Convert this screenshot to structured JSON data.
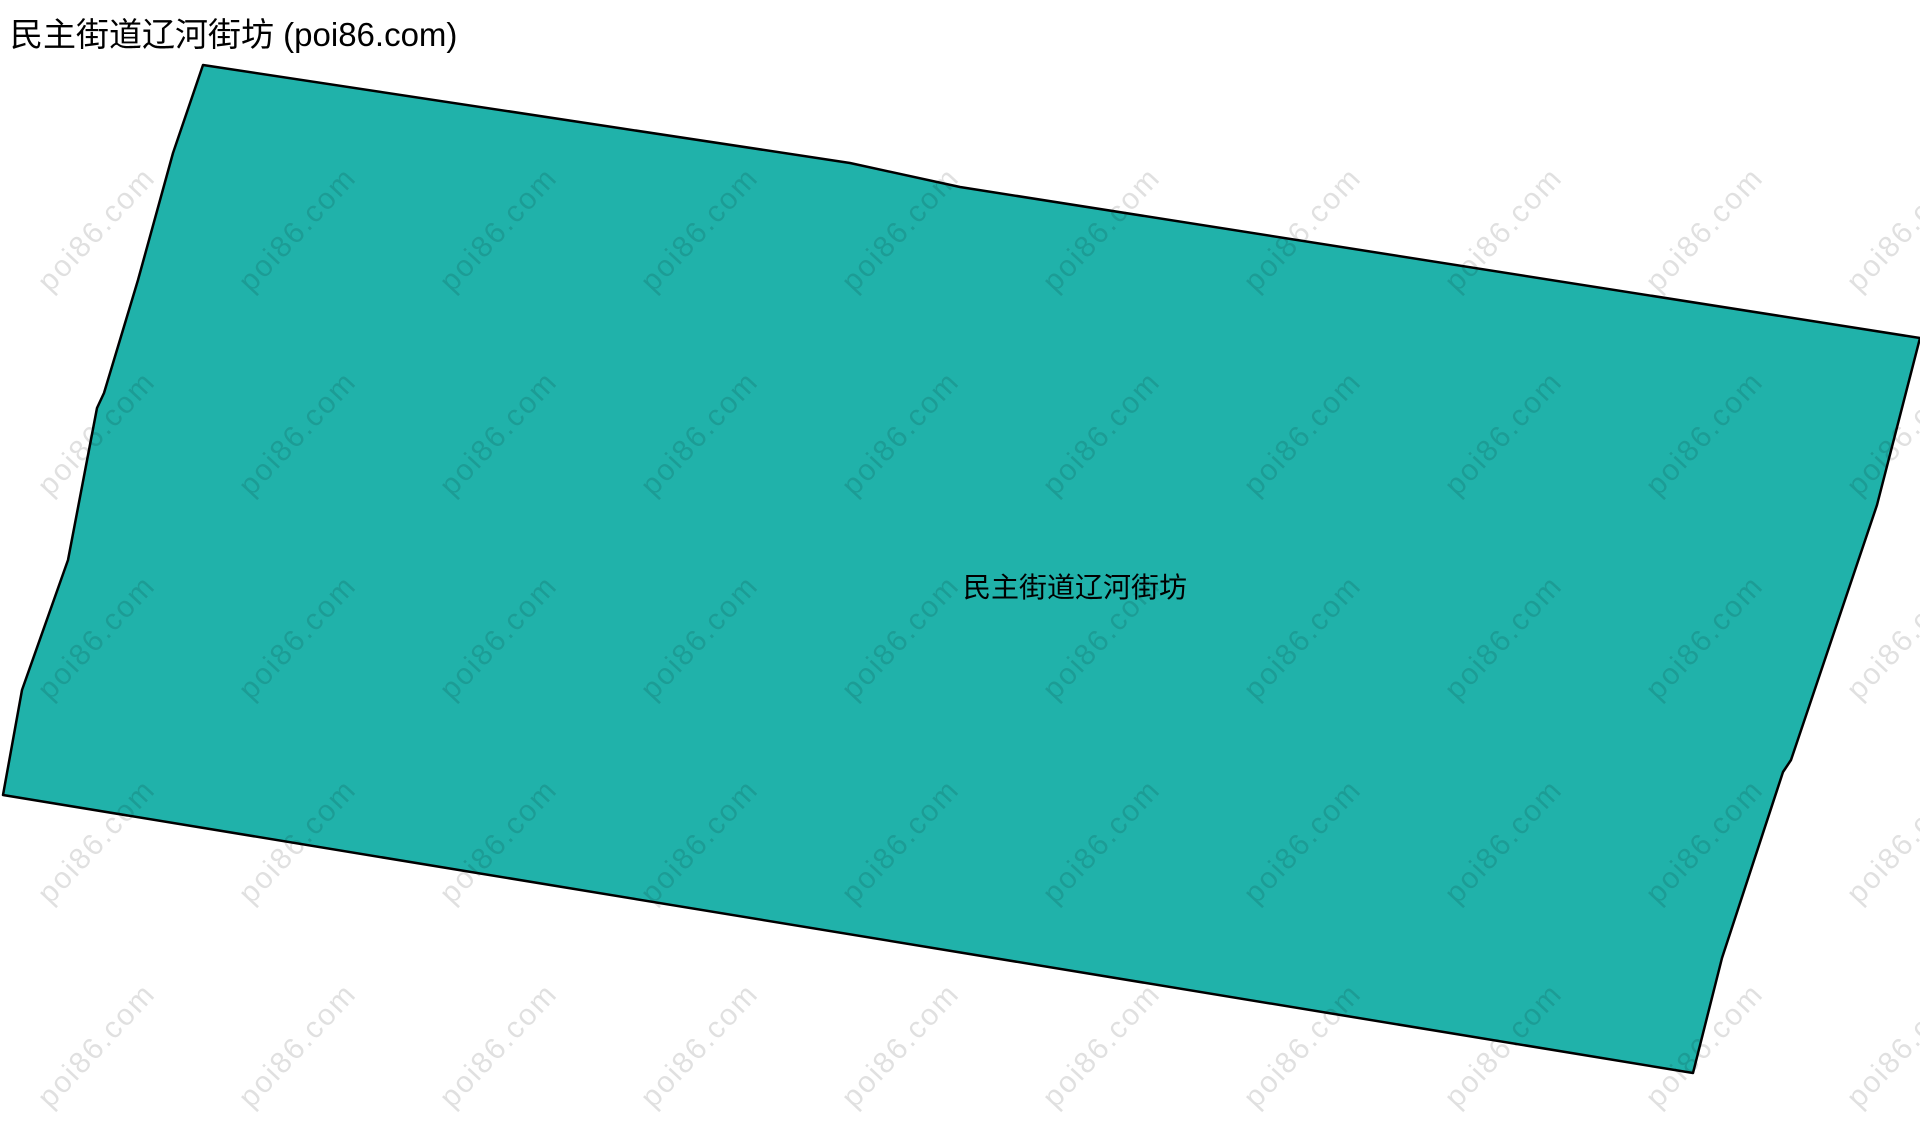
{
  "page": {
    "title": "民主街道辽河街坊 (poi86.com)"
  },
  "map": {
    "region_label": "民主街道辽河街坊",
    "fill_color": "#20b2aa",
    "border_color": "#000000",
    "border_width": 2.5,
    "polygon_points": [
      [
        203,
        65
      ],
      [
        850,
        163
      ],
      [
        960,
        187
      ],
      [
        1920,
        338
      ],
      [
        1877,
        505
      ],
      [
        1791,
        760
      ],
      [
        1783,
        772
      ],
      [
        1722,
        958
      ],
      [
        1693,
        1073
      ],
      [
        3,
        795
      ],
      [
        22,
        690
      ],
      [
        68,
        560
      ],
      [
        97,
        408
      ],
      [
        104,
        393
      ],
      [
        138,
        280
      ],
      [
        173,
        153
      ]
    ]
  },
  "watermark": {
    "text": "poi86.com",
    "color": "rgba(0, 0, 0, 0.12)",
    "grid": {
      "start_x": 97,
      "start_y": 230,
      "step_x": 201,
      "step_y": 204,
      "cols": 10,
      "rows": 5
    }
  }
}
